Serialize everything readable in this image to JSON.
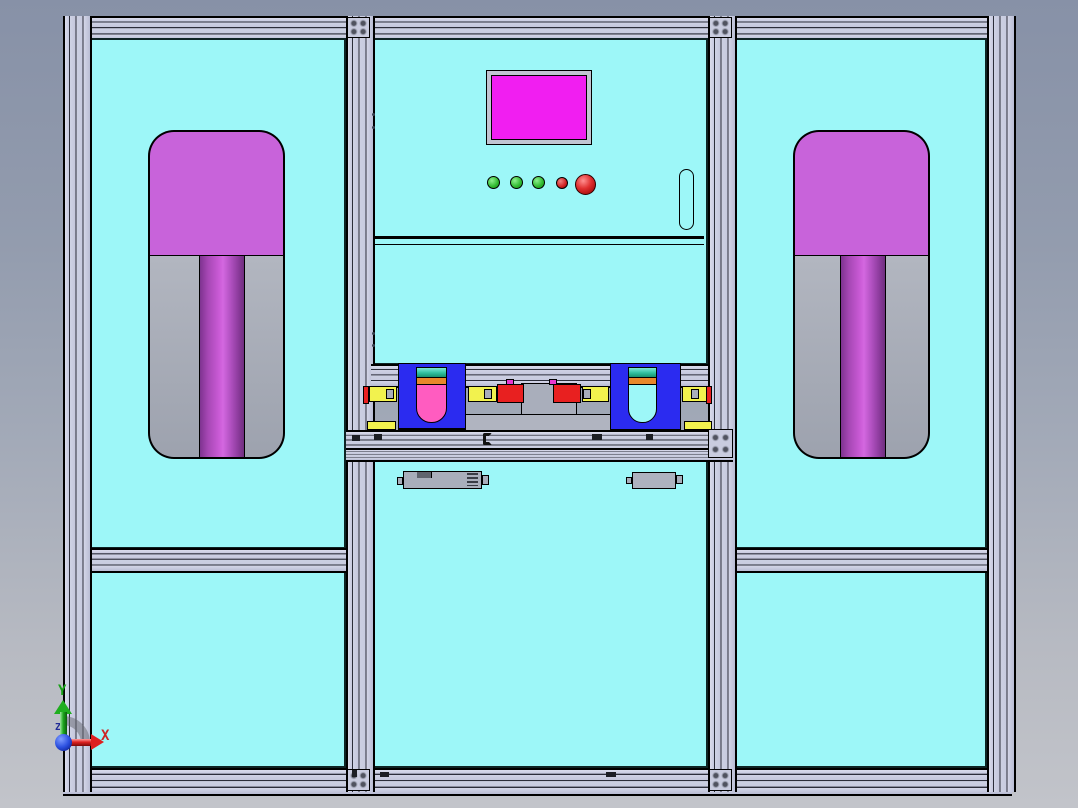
{
  "scene": {
    "type": "cad-front-view",
    "background_top": "#8791a7",
    "background_bottom": "#c2c4ca"
  },
  "triad": {
    "x_label": "X",
    "y_label": "Y",
    "z_label": "Z",
    "x_color": "#cc2424",
    "y_color": "#17a017",
    "z_color": "#202a96"
  },
  "machine": {
    "frame_color": "#c8cbe0",
    "panel_color": "#9df7f8",
    "hmi_screen_color": "#f11ef1",
    "screen_frame_color": "#c2c5d2",
    "indicator_lights": [
      {
        "name": "indicator-1",
        "color": "green"
      },
      {
        "name": "indicator-2",
        "color": "green"
      },
      {
        "name": "indicator-3",
        "color": "green"
      },
      {
        "name": "indicator-4",
        "color": "red"
      },
      {
        "name": "emergency-stop",
        "color": "red"
      }
    ],
    "fixture_top_color": "#c863da",
    "fixture_body_color": "#a8adb8",
    "cylinder_color": "#c056cc",
    "gripper_color": "#2b2bf0",
    "gripper_left_insert_color": "#ff5cc0",
    "band_teal": "#2fbf9f",
    "band_orange": "#e8872b",
    "rail_yellow": "#f2f24e",
    "clamp_red": "#e82020",
    "nub_pink": "#e838d0"
  }
}
